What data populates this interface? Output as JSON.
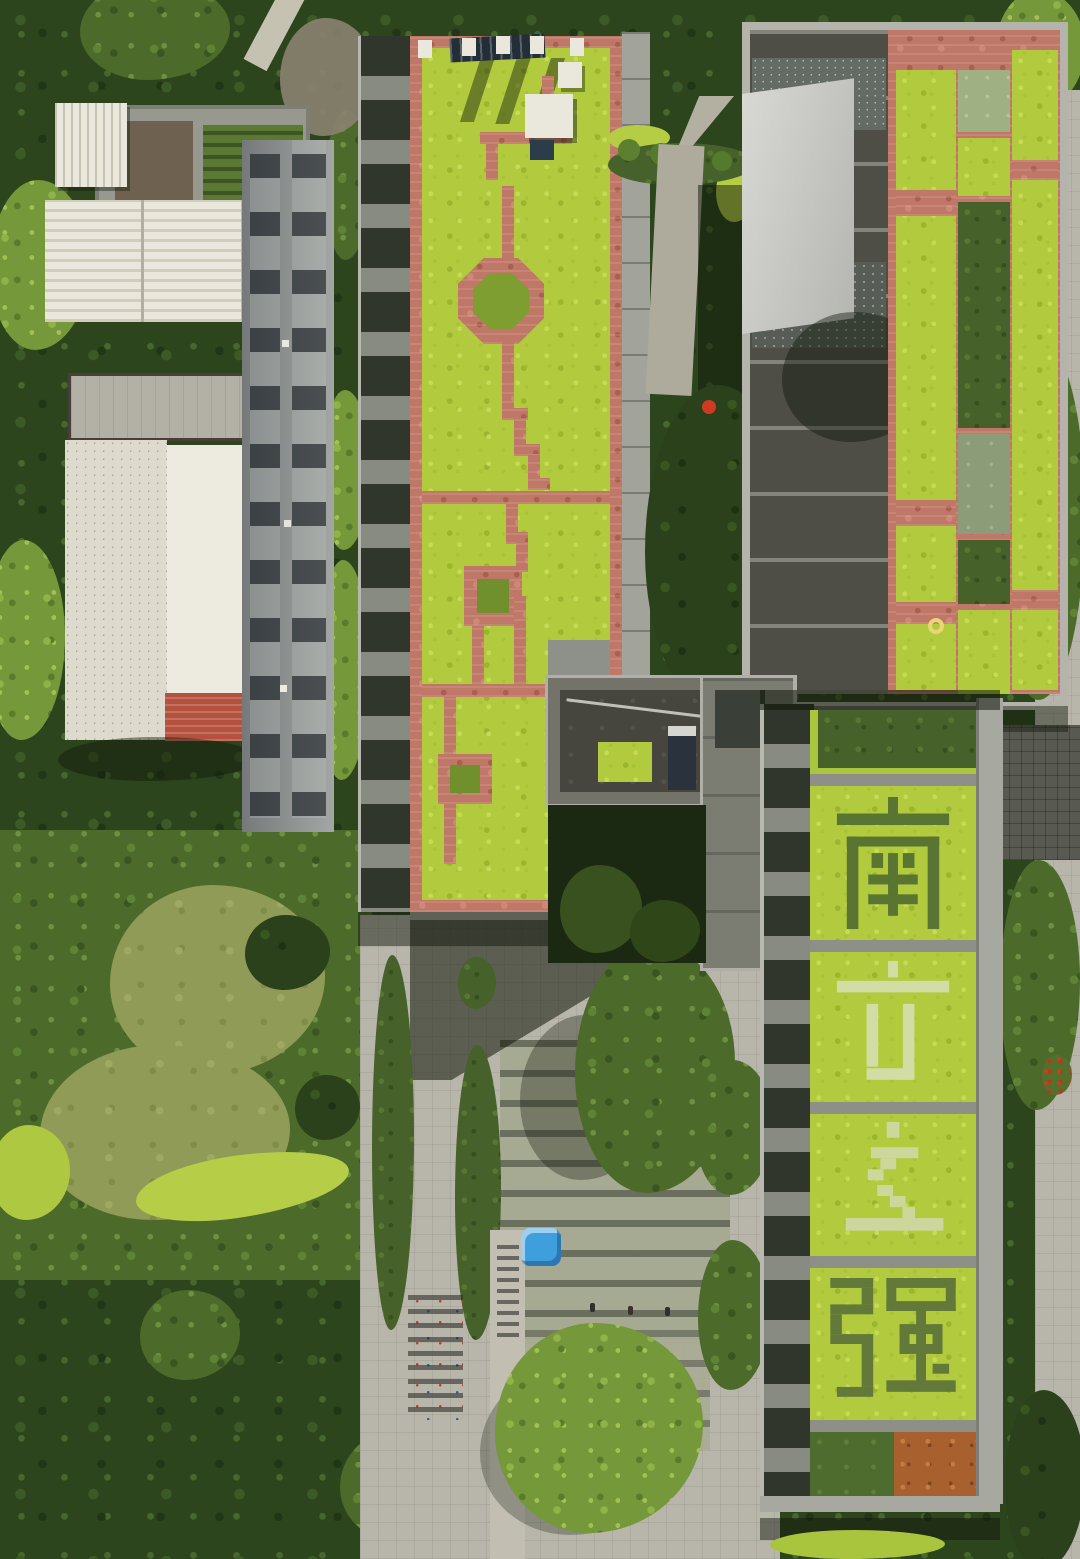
{
  "image": {
    "kind": "aerial-drone-photograph",
    "scene": "Top-down view of campus buildings with sedum green roofs, brick roof paths, a paved courtyard with hedges and bike racks, and dense tree canopy",
    "motto": {
      "full_text": "南方之强",
      "characters": [
        "南",
        "方",
        "之",
        "强"
      ]
    },
    "colors": {
      "sedum_green": "#b2cb3e",
      "topiary_dark": "#5a7431",
      "topiary_pale": "#d3dca4",
      "brick_path": "#bf7767",
      "hedge_dark": "#46612a",
      "canopy_dark": "#2d451d",
      "canopy_bright": "#75983a",
      "lawn": "#8f9b57",
      "paving": "#b8b5aa",
      "roof_dark_gray": "#4e4e46",
      "white_roof": "#eae8dd",
      "red_tile": "#b5513f",
      "orange_plot": "#a8602f",
      "blue_canopy": "#3f9fdc",
      "yellow_ring": "#ead574"
    }
  }
}
